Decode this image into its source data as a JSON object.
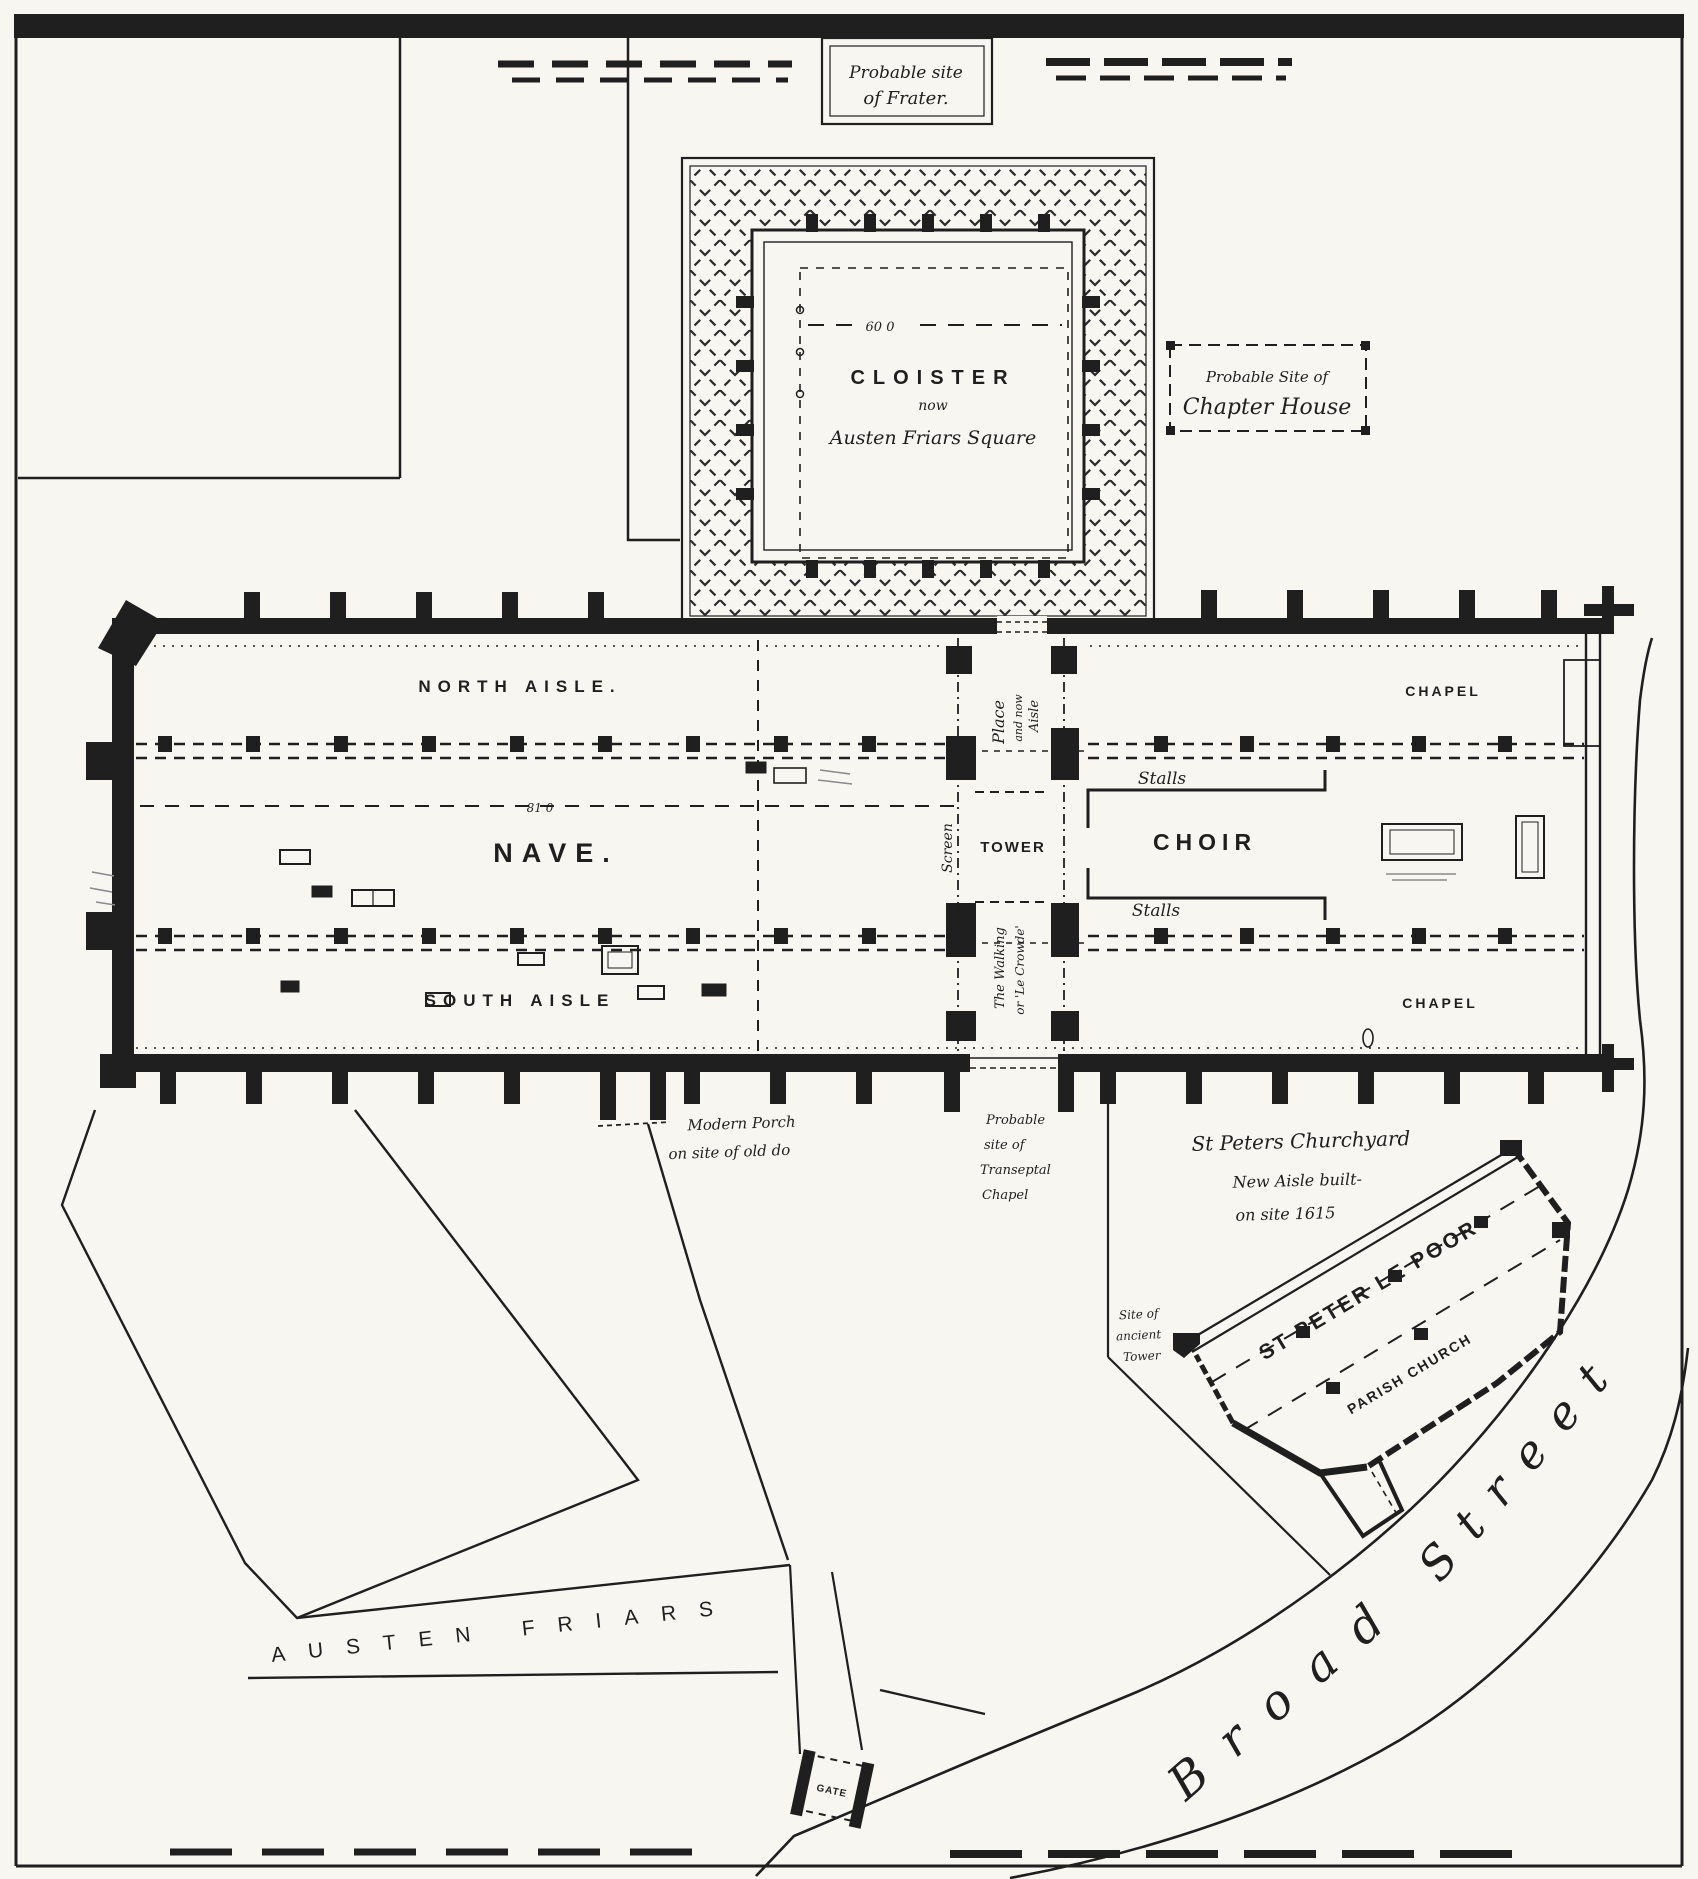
{
  "colors": {
    "paper": "#f8f6f1",
    "ink": "#1f1f1f"
  },
  "frater_box": {
    "line1": "Probable site",
    "line2": "of Frater."
  },
  "chapter_box": {
    "line1": "Probable Site of",
    "line2": "Chapter House"
  },
  "cloister": {
    "title": "CLOISTER",
    "mid": "now",
    "sub": "Austen Friars Square",
    "dim": "60 0"
  },
  "church": {
    "north_aisle": "NORTH AISLE.",
    "nave": "NAVE.",
    "nave_dim": "81 0",
    "south_aisle": "SOUTH AISLE",
    "tower": "TOWER",
    "screen": "Screen",
    "place_lines": [
      "Place",
      "and now",
      "Aisle"
    ],
    "walking_lines": [
      "The Walking",
      "or 'Le Crowde'"
    ],
    "choir": "CHOIR",
    "stalls": "Stalls",
    "chapel": "CHAPEL"
  },
  "notes": {
    "porch": [
      "Modern Porch",
      "on site of old do"
    ],
    "transept": [
      "Probable",
      "site of",
      "Transeptal",
      "Chapel"
    ],
    "churchyard": "St Peters Churchyard",
    "new_aisle": [
      "New Aisle built-",
      "on site 1615"
    ],
    "tower_site": [
      "Site of",
      "ancient",
      "Tower"
    ]
  },
  "stpeter": {
    "name": "ST PETER LE POOR",
    "type": "PARISH CHURCH"
  },
  "streets": {
    "broad": [
      "Broad",
      "Street"
    ],
    "austen": "AUSTEN FRIARS",
    "gate": "GATE"
  }
}
